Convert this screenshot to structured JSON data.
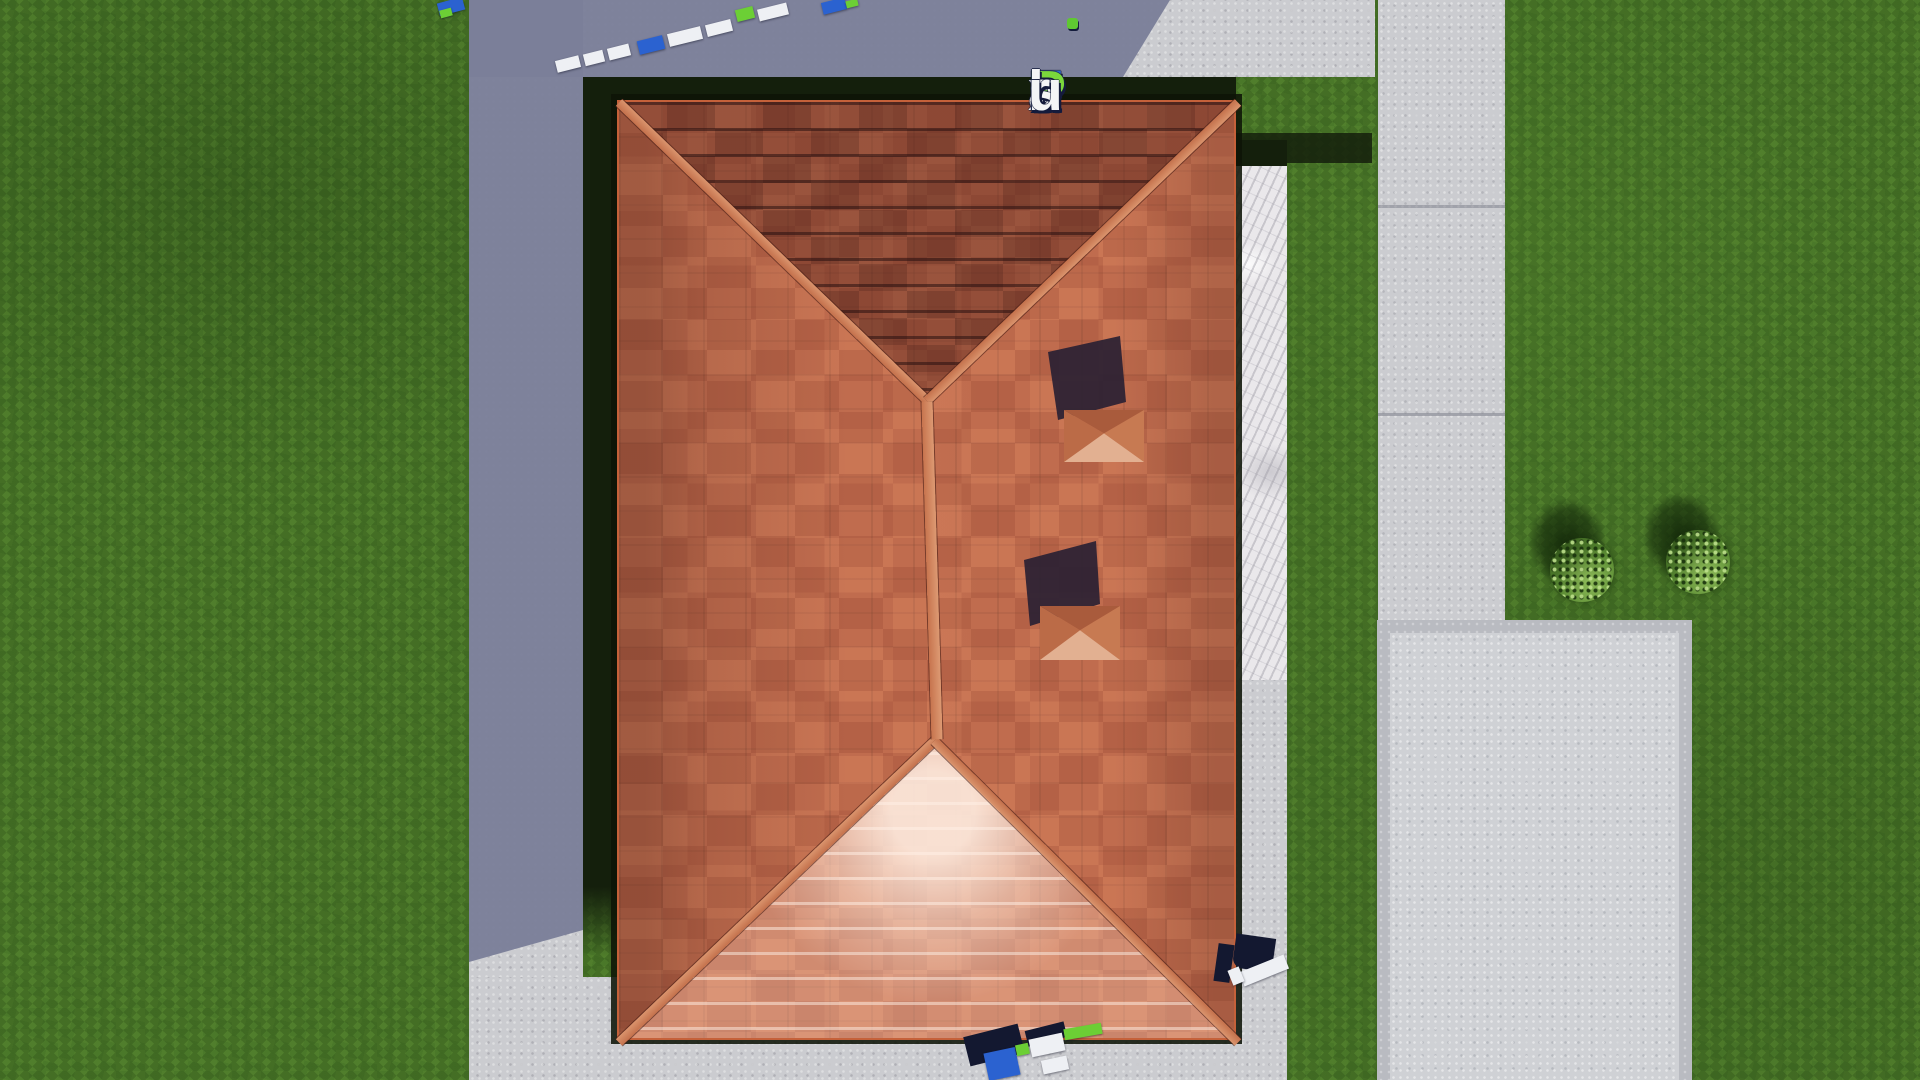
{
  "watermark": {
    "text": "FixPlans.ru",
    "letters": [
      {
        "ch": "F",
        "color": "#2d6bc9"
      },
      {
        "ch": "i",
        "color": "#f3f4f6"
      },
      {
        "ch": "x",
        "color": "#f3f4f6"
      },
      {
        "ch": "P",
        "color": "#7bd83c"
      },
      {
        "ch": "l",
        "color": "#f3f4f6"
      },
      {
        "ch": "a",
        "color": "#f3f4f6"
      },
      {
        "ch": "n",
        "color": "#f3f4f6"
      },
      {
        "ch": "s",
        "color": "#f3f4f6"
      },
      {
        "ch": ".",
        "color": "#2f86dd"
      },
      {
        "ch": "r",
        "color": "#f3f4f6"
      },
      {
        "ch": "u",
        "color": "#f3f4f6"
      }
    ],
    "i_dot_color": "#5fc832",
    "outline_color": "#141b3c"
  },
  "palette": {
    "grass_base": "#4a7829",
    "grass_shadow": "#141f0c",
    "concrete_lit": "#cbccd0",
    "concrete_shadow": "#7b7f99",
    "pad_border": "#b9bbc1",
    "pad_fill": "#cfd1d5",
    "terrace_marble": "#eae8eb",
    "roof_tile": "#c06c4e",
    "roof_ridge": "#d8916b",
    "roof_fascia": "#c5613a",
    "chimney_shadow": "#2a2133",
    "bush_green": "#55862f",
    "letter_white": "#eef0f4",
    "letter_blue": "#2b62d0",
    "letter_green": "#6ccf35",
    "letter_dark": "#131830"
  }
}
